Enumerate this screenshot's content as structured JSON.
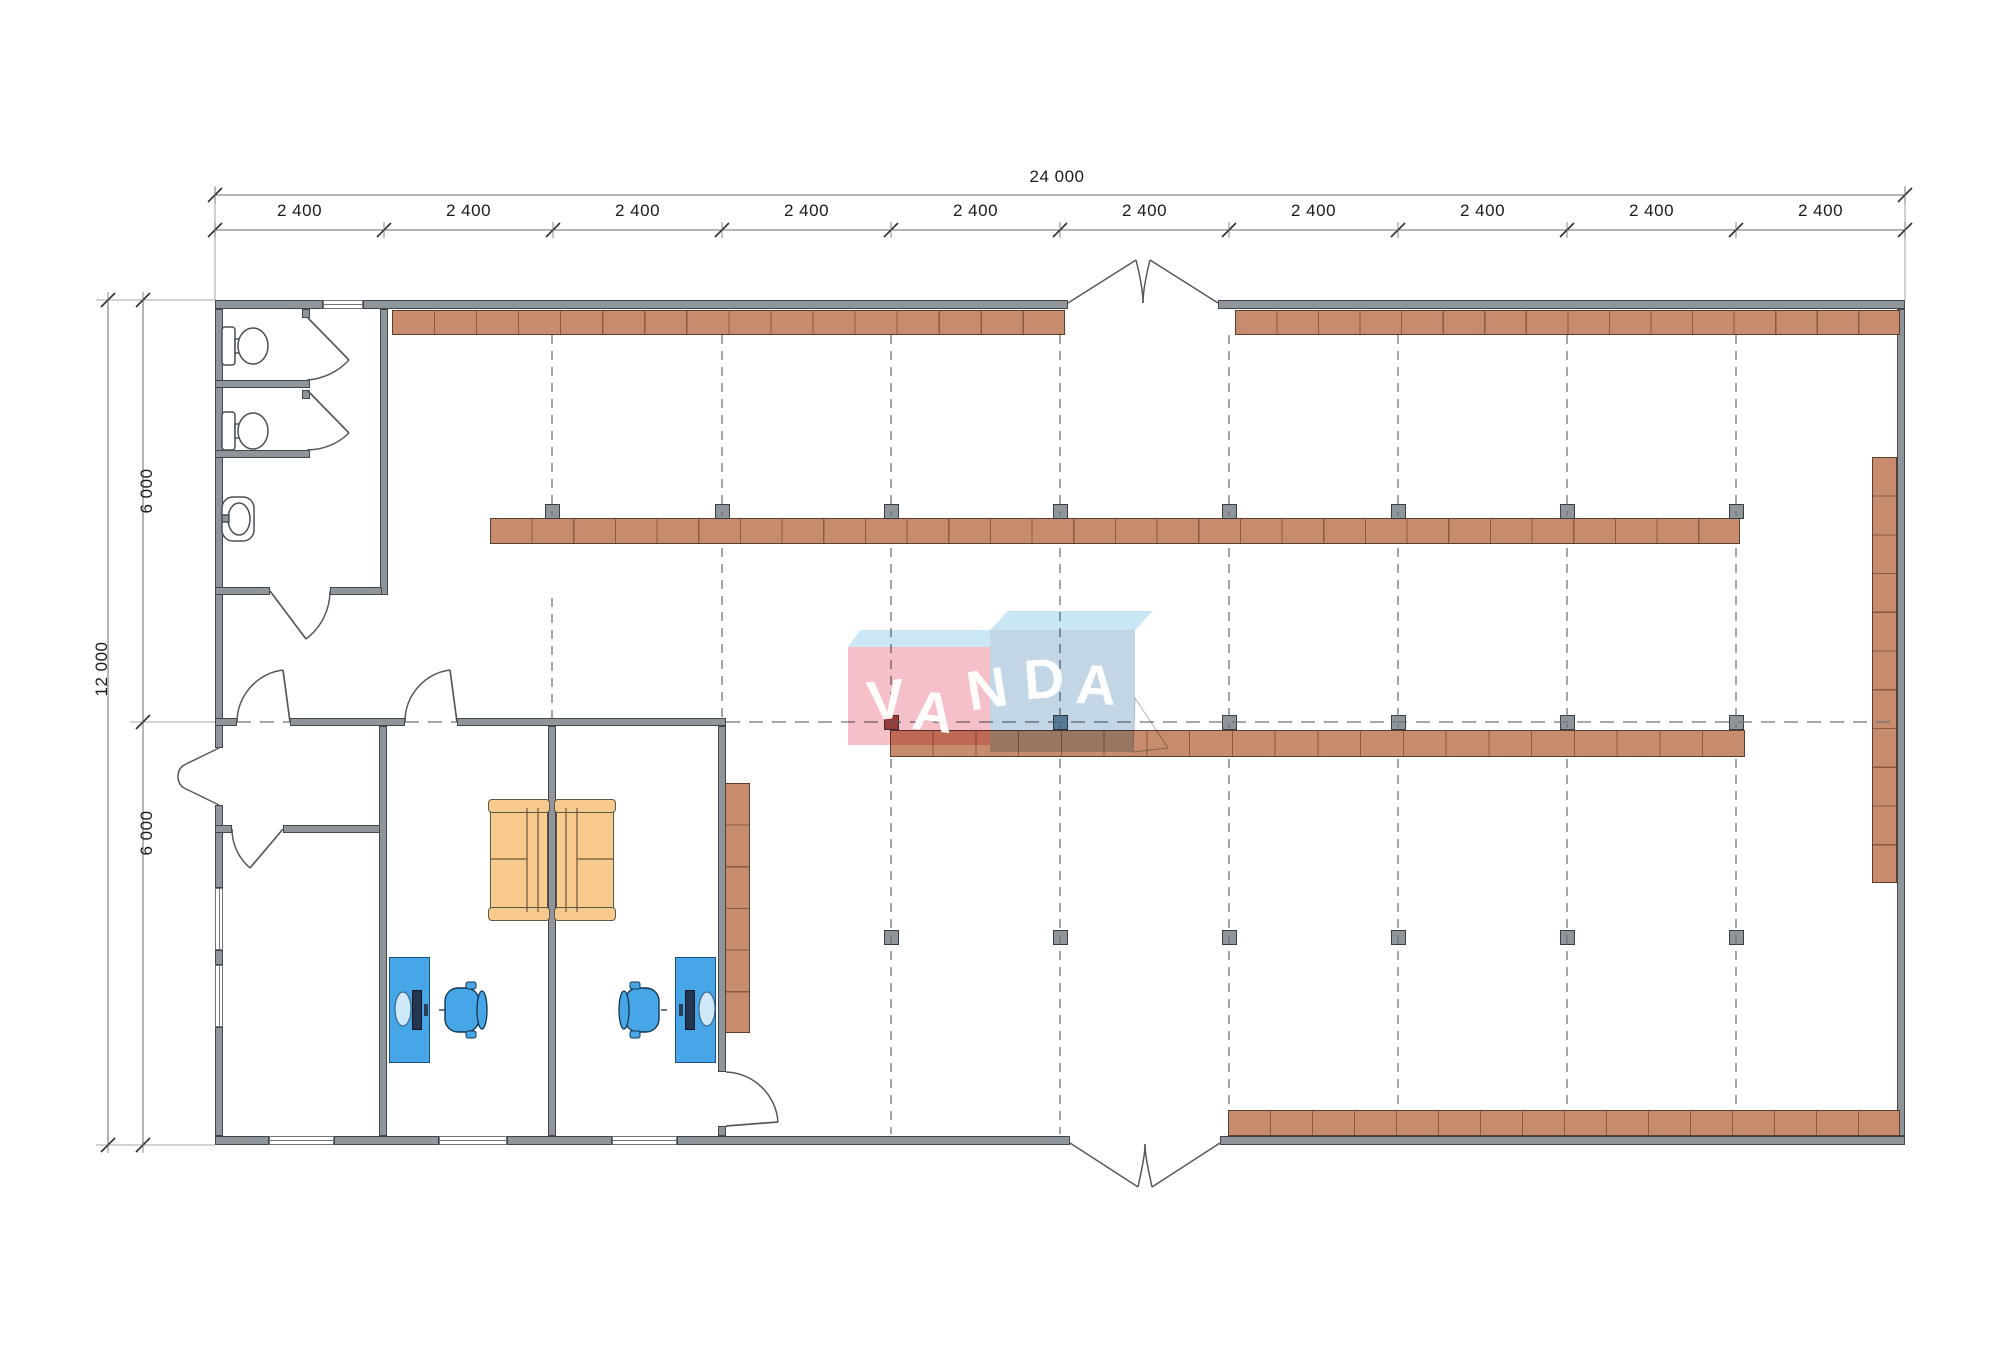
{
  "title": "warehouse-floor-plan",
  "watermark": {
    "text": "VANDA"
  },
  "colors": {
    "wall_fill": "#8e959b",
    "wall_edge": "#43474b",
    "shelf_fill": "#c68c6d",
    "shelf_edge": "#5d3d2c",
    "shelf_line": "#8a5a42",
    "dash": "#6f7579",
    "column_gray": "#8e959b",
    "column_red": "#a24a41",
    "column_blue": "#6e92a9",
    "column_edge": "#3a3e41",
    "desk": "#47a6e8",
    "desk_edge": "#1a4f7e",
    "monitor": "#243552",
    "couch": "#f8ca8e",
    "couch_edge": "#5f5746",
    "couch_line": "#6b5a3a",
    "door_stroke": "#55595d",
    "fixture_stroke": "#4a4f53",
    "dim_line": "#6a6a6a",
    "dim_ext": "#8a8a8a",
    "dim_tick": "#2f2f2f",
    "dim_text": "#1b1b1b",
    "logo_top_face": "#cbe7f6",
    "logo_top_face2": "#c9e6f5",
    "logo_pink_front": "#f5c0c8",
    "logo_blue_front": "#c2d6e5",
    "logo_fold_edge": "#a8b6bf"
  },
  "dims": {
    "top_total": {
      "text": "24 000",
      "x": 1057,
      "y": 177
    },
    "left_total": {
      "text": "12 000",
      "x": 102,
      "y": 669
    },
    "top_segments": [
      "2 400",
      "2 400",
      "2 400",
      "2 400",
      "2 400",
      "2 400",
      "2 400",
      "2 400",
      "2 400",
      "2 400"
    ],
    "top_seg_y": 211,
    "top_x0": 215,
    "top_pitch": 169,
    "left_segments": [
      {
        "text": "6 000",
        "x": 147,
        "y": 491
      },
      {
        "text": "6 000",
        "x": 147,
        "y": 833
      }
    ],
    "lines": [
      {
        "x1": 215,
        "y1": 195,
        "x2": 1905,
        "y2": 195
      },
      {
        "x1": 215,
        "y1": 230,
        "x2": 1905,
        "y2": 230
      },
      {
        "x1": 108,
        "y1": 300,
        "x2": 108,
        "y2": 1145
      },
      {
        "x1": 143,
        "y1": 300,
        "x2": 143,
        "y2": 1145
      }
    ],
    "ticks_top1": [
      [
        215,
        195
      ],
      [
        1905,
        195
      ]
    ],
    "ticks_top2_n": 11,
    "ticks_left1": [
      [
        108,
        300
      ],
      [
        108,
        1145
      ]
    ],
    "ticks_left2": [
      [
        143,
        300
      ],
      [
        143,
        722
      ],
      [
        143,
        1145
      ]
    ],
    "extensions": [
      "M215 300 L215 186",
      "M1905 300 L1905 186",
      "M215 300 L96 300",
      "M215 1145 L96 1145",
      "M215 722 L130 722"
    ]
  },
  "walls": [
    [
      215,
      300,
      108,
      9
    ],
    [
      363,
      300,
      705,
      9
    ],
    [
      1218,
      300,
      687,
      9
    ],
    [
      215,
      1136,
      54,
      9
    ],
    [
      334,
      1136,
      105,
      9
    ],
    [
      507,
      1136,
      105,
      9
    ],
    [
      677,
      1136,
      393,
      9
    ],
    [
      1220,
      1136,
      685,
      9
    ],
    [
      215,
      309,
      8,
      439
    ],
    [
      215,
      805,
      8,
      83
    ],
    [
      215,
      950,
      8,
      15
    ],
    [
      215,
      1027,
      8,
      109
    ],
    [
      1897,
      309,
      8,
      827
    ],
    [
      380,
      309,
      8,
      286
    ],
    [
      215,
      380,
      95,
      8
    ],
    [
      215,
      450,
      95,
      8
    ],
    [
      302,
      309,
      8,
      9
    ],
    [
      302,
      390,
      8,
      9
    ],
    [
      215,
      587,
      55,
      8
    ],
    [
      330,
      587,
      52,
      8
    ],
    [
      215,
      718,
      22,
      8
    ],
    [
      290,
      718,
      115,
      8
    ],
    [
      457,
      718,
      269,
      8
    ],
    [
      215,
      825,
      17,
      8
    ],
    [
      283,
      825,
      100,
      8
    ],
    [
      379,
      726,
      8,
      410
    ],
    [
      548,
      726,
      8,
      410
    ],
    [
      718,
      726,
      8,
      346
    ],
    [
      718,
      1126,
      8,
      10
    ]
  ],
  "windows": [
    {
      "x": 323,
      "y": 300,
      "w": 40,
      "h": 9,
      "o": "h"
    },
    {
      "x": 269,
      "y": 1136,
      "w": 65,
      "h": 9,
      "o": "h"
    },
    {
      "x": 439,
      "y": 1136,
      "w": 68,
      "h": 9,
      "o": "h"
    },
    {
      "x": 612,
      "y": 1136,
      "w": 65,
      "h": 9,
      "o": "h"
    },
    {
      "x": 215,
      "y": 888,
      "w": 8,
      "h": 62,
      "o": "v"
    },
    {
      "x": 215,
      "y": 965,
      "w": 8,
      "h": 62,
      "o": "v"
    }
  ],
  "shelves": [
    {
      "x": 392,
      "y": 310,
      "w": 673,
      "h": 25,
      "cells": 16,
      "o": "h"
    },
    {
      "x": 1235,
      "y": 310,
      "w": 665,
      "h": 25,
      "cells": 16,
      "o": "h"
    },
    {
      "x": 490,
      "y": 518,
      "w": 1250,
      "h": 26,
      "cells": 30,
      "o": "h"
    },
    {
      "x": 890,
      "y": 730,
      "w": 855,
      "h": 27,
      "cells": 20,
      "o": "h"
    },
    {
      "x": 1228,
      "y": 1110,
      "w": 672,
      "h": 26,
      "cells": 16,
      "o": "h"
    },
    {
      "x": 1872,
      "y": 457,
      "w": 25,
      "h": 426,
      "cells": 11,
      "o": "v"
    },
    {
      "x": 725,
      "y": 783,
      "w": 25,
      "h": 250,
      "cells": 6,
      "o": "v"
    }
  ],
  "grid_v": [
    [
      552,
      335,
      516
    ],
    [
      552,
      598,
      718
    ],
    [
      722,
      335,
      516
    ],
    [
      722,
      548,
      718
    ],
    [
      891,
      335,
      516
    ],
    [
      891,
      548,
      728
    ],
    [
      891,
      759,
      1134
    ],
    [
      1060,
      335,
      516
    ],
    [
      1060,
      548,
      728
    ],
    [
      1060,
      759,
      1134
    ],
    [
      1229,
      335,
      516
    ],
    [
      1229,
      548,
      728
    ],
    [
      1229,
      759,
      1108
    ],
    [
      1398,
      335,
      516
    ],
    [
      1398,
      548,
      728
    ],
    [
      1398,
      759,
      1108
    ],
    [
      1567,
      335,
      516
    ],
    [
      1567,
      548,
      728
    ],
    [
      1567,
      759,
      1108
    ],
    [
      1736,
      335,
      516
    ],
    [
      1736,
      548,
      728
    ],
    [
      1736,
      759,
      1108
    ]
  ],
  "grid_h": [
    [
      722,
      726,
      1897
    ],
    [
      722,
      237,
      290
    ],
    [
      722,
      405,
      457
    ]
  ],
  "columns": [
    {
      "x": 552,
      "y": 511,
      "c": "gray"
    },
    {
      "x": 722,
      "y": 511,
      "c": "gray"
    },
    {
      "x": 891,
      "y": 511,
      "c": "gray"
    },
    {
      "x": 1060,
      "y": 511,
      "c": "gray"
    },
    {
      "x": 1229,
      "y": 511,
      "c": "gray"
    },
    {
      "x": 1398,
      "y": 511,
      "c": "gray"
    },
    {
      "x": 1567,
      "y": 511,
      "c": "gray"
    },
    {
      "x": 1736,
      "y": 511,
      "c": "gray"
    },
    {
      "x": 891,
      "y": 722,
      "c": "red"
    },
    {
      "x": 1060,
      "y": 722,
      "c": "blue"
    },
    {
      "x": 1229,
      "y": 722,
      "c": "gray"
    },
    {
      "x": 1398,
      "y": 722,
      "c": "gray"
    },
    {
      "x": 1567,
      "y": 722,
      "c": "gray"
    },
    {
      "x": 1736,
      "y": 722,
      "c": "gray"
    },
    {
      "x": 891,
      "y": 937,
      "c": "gray"
    },
    {
      "x": 1060,
      "y": 937,
      "c": "gray"
    },
    {
      "x": 1229,
      "y": 937,
      "c": "gray"
    },
    {
      "x": 1398,
      "y": 937,
      "c": "gray"
    },
    {
      "x": 1567,
      "y": 937,
      "c": "gray"
    },
    {
      "x": 1736,
      "y": 937,
      "c": "gray"
    }
  ],
  "desks": [
    {
      "x": 389,
      "y": 957,
      "w": 41,
      "h": 106,
      "slab": [
        412,
        990,
        10,
        40
      ],
      "oval": [
        403,
        1009,
        8,
        17
      ],
      "pad": [
        424,
        1004,
        4,
        12
      ]
    },
    {
      "x": 675,
      "y": 957,
      "w": 41,
      "h": 106,
      "slab": [
        685,
        990,
        10,
        40
      ],
      "oval": [
        707,
        1009,
        8,
        17
      ],
      "pad": [
        679,
        1004,
        4,
        12
      ]
    }
  ],
  "chairs": [
    {
      "cx": 463,
      "cy": 1010,
      "back": "right"
    },
    {
      "cx": 643,
      "cy": 1010,
      "back": "left"
    }
  ],
  "couches": [
    {
      "x": 490,
      "y": 802,
      "w": 58,
      "h": 116,
      "back": "right"
    },
    {
      "x": 556,
      "y": 802,
      "w": 58,
      "h": 116,
      "back": "left"
    }
  ],
  "toilets": [
    {
      "x": 222,
      "y": 327
    },
    {
      "x": 222,
      "y": 412
    }
  ],
  "sink": {
    "x": 222,
    "y": 497,
    "w": 32,
    "h": 44
  },
  "doors": [
    {
      "arc": "M307 380 A63 63 0 0 0 349 360",
      "leaf": "M307 317 L349 360"
    },
    {
      "arc": "M307 450 A60 60 0 0 0 349 433",
      "leaf": "M307 390 L349 433"
    },
    {
      "arc": "M330 591 A60 60 0 0 1 306 639",
      "leaf": "M270 591 L306 639"
    },
    {
      "arc": "M237 722 A53 53 0 0 1 283 670",
      "leaf": "M290 722 L283 670"
    },
    {
      "arc": "M405 722 A52 52 0 0 1 450 670",
      "leaf": "M457 722 L450 670"
    },
    {
      "arc": "M232 829 A51 51 0 0 0 250 868",
      "leaf": "M283 829 L250 868"
    },
    {
      "arc": "M726 1072 A54 54 0 0 1 778 1122",
      "leaf": "M726 1126 L778 1122"
    }
  ],
  "entrances": [
    "M1068 303 L1136 260",
    "M1218 303 L1150 260",
    "M1136 260 C1141 280 1143 293 1143 303",
    "M1150 260 C1145 280 1143 293 1143 303",
    "M1070 1143 L1138 1187",
    "M1220 1143 L1152 1187",
    "M1138 1187 C1142 1168 1145 1155 1145 1144",
    "M1152 1187 C1148 1168 1145 1155 1145 1144",
    "M219 748 L184 765",
    "M219 805 L184 788",
    "M184 765 C176 770 176 783 184 788"
  ],
  "logo": {
    "faces": [
      {
        "type": "poly",
        "pts": "848,647 860,630 1002,630 990,647",
        "fill": "logo_top_face"
      },
      {
        "type": "rect",
        "x": 848,
        "y": 647,
        "w": 142,
        "h": 98,
        "fill": "logo_pink_front"
      },
      {
        "type": "poly",
        "pts": "990,630 1008,611 1153,611 1135,630",
        "fill": "logo_top_face2"
      },
      {
        "type": "rect",
        "x": 990,
        "y": 630,
        "w": 145,
        "h": 122,
        "fill": "logo_blue_front"
      },
      {
        "type": "poly",
        "pts": "1135,698 1168,748 1133,752",
        "fill": "#ffffff",
        "stroke": "logo_fold_edge"
      }
    ],
    "letters": [
      {
        "ch": "V",
        "x": 886,
        "y": 700,
        "r": -6,
        "s": 56
      },
      {
        "ch": "A",
        "x": 933,
        "y": 712,
        "r": 7,
        "s": 56
      },
      {
        "ch": "N",
        "x": 987,
        "y": 689,
        "r": -9,
        "s": 56
      },
      {
        "ch": "D",
        "x": 1044,
        "y": 679,
        "r": -4,
        "s": 56
      },
      {
        "ch": "A",
        "x": 1096,
        "y": 685,
        "r": 3,
        "s": 56
      }
    ]
  }
}
